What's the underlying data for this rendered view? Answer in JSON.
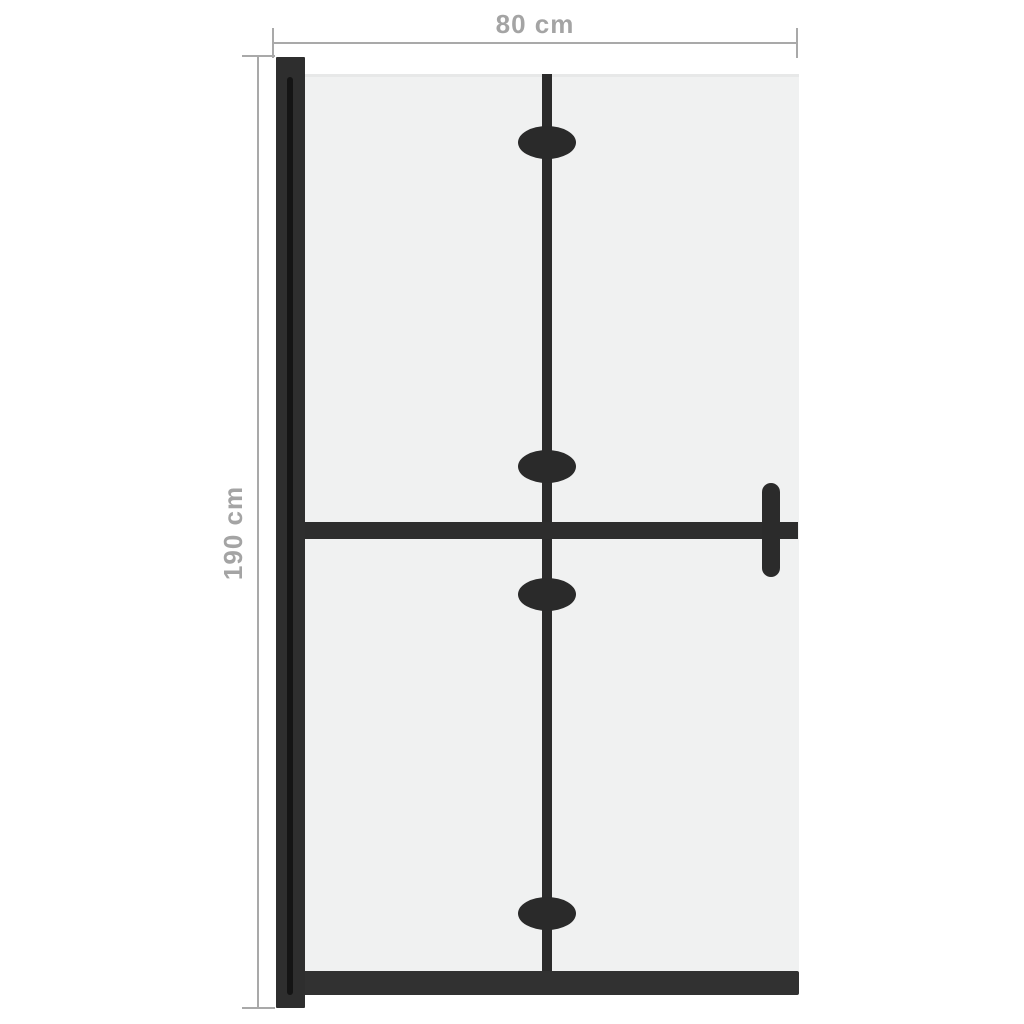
{
  "diagram": {
    "product": "foldable-walk-in-shower-screen",
    "dimensions": {
      "width_label": "80 cm",
      "height_label": "190 cm",
      "width_cm": 80,
      "height_cm": 190
    },
    "parts": {
      "wall_profile": "left wall mounting profile",
      "glass_panel": "frosted glass panel",
      "fold_line": "central fold line",
      "hinge_count": 4,
      "crossbar": "horizontal stabilizer bar",
      "support_bracket": "wall support bracket",
      "bottom_rail": "bottom frame rail"
    },
    "colors": {
      "frame": "#2d2d2d",
      "glass": "#f0f1f1",
      "dimension_line": "#a9a9a9",
      "dimension_text": "#a4a4a4",
      "background": "#ffffff"
    }
  }
}
